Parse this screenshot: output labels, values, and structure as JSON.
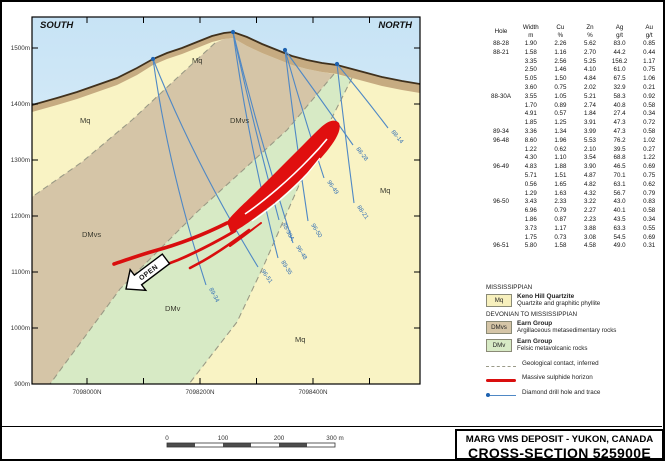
{
  "section": {
    "south_label": "SOUTH",
    "north_label": "NORTH",
    "elevation_labels": [
      "1500m",
      "1400m",
      "1300m",
      "1200m",
      "1100m",
      "1000m",
      "900m"
    ],
    "northing_labels": [
      "7098000N",
      "7098200N",
      "7098400N"
    ],
    "unit_labels": {
      "mq": "Mq",
      "dmvs": "DMvs",
      "dmv": "DMv"
    },
    "open_label": "OPEN",
    "drill_hole_labels": [
      "88-14",
      "88-28",
      "88-21",
      "96-49",
      "96-50",
      "88-30A",
      "96-48",
      "89-35",
      "96-51",
      "89-34"
    ]
  },
  "table": {
    "headers": {
      "hole": "Hole",
      "width": [
        "Width",
        "m"
      ],
      "cu": [
        "Cu",
        "%"
      ],
      "zn": [
        "Zn",
        "%"
      ],
      "ag": [
        "Ag",
        "g/t"
      ],
      "au": [
        "Au",
        "g/t"
      ]
    },
    "rows": [
      [
        "88-28",
        "1.90",
        "2.26",
        "5.62",
        "83.0",
        "0.85"
      ],
      [
        "88-21",
        "1.58",
        "1.16",
        "2.70",
        "44.2",
        "0.44"
      ],
      [
        "",
        "3.35",
        "2.56",
        "5.25",
        "156.2",
        "1.17"
      ],
      [
        "",
        "2.50",
        "1.46",
        "4.10",
        "61.0",
        "0.75"
      ],
      [
        "",
        "5.05",
        "1.50",
        "4.84",
        "67.5",
        "1.06"
      ],
      [
        "",
        "3.60",
        "0.75",
        "2.02",
        "32.9",
        "0.21"
      ],
      [
        "88-30A",
        "3.55",
        "1.05",
        "5.21",
        "58.3",
        "0.92"
      ],
      [
        "",
        "1.70",
        "0.89",
        "2.74",
        "40.8",
        "0.58"
      ],
      [
        "",
        "4.91",
        "0.57",
        "1.84",
        "27.4",
        "0.34"
      ],
      [
        "",
        "1.85",
        "1.25",
        "3.91",
        "47.3",
        "0.72"
      ],
      [
        "89-34",
        "3.36",
        "1.34",
        "3.99",
        "47.3",
        "0.58"
      ],
      [
        "96-48",
        "8.60",
        "1.96",
        "5.53",
        "76.2",
        "1.02"
      ],
      [
        "",
        "1.22",
        "0.62",
        "2.10",
        "39.5",
        "0.27"
      ],
      [
        "",
        "4.30",
        "1.10",
        "3.54",
        "68.8",
        "1.22"
      ],
      [
        "96-49",
        "4.83",
        "1.88",
        "3.90",
        "46.5",
        "0.69"
      ],
      [
        "",
        "5.71",
        "1.51",
        "4.87",
        "70.1",
        "0.75"
      ],
      [
        "",
        "0.56",
        "1.65",
        "4.82",
        "63.1",
        "0.62"
      ],
      [
        "",
        "1.29",
        "1.63",
        "4.32",
        "56.7",
        "0.79"
      ],
      [
        "96-50",
        "3.43",
        "2.33",
        "3.22",
        "43.0",
        "0.83"
      ],
      [
        "",
        "6.96",
        "0.79",
        "2.27",
        "40.1",
        "0.58"
      ],
      [
        "",
        "1.86",
        "0.87",
        "2.23",
        "43.5",
        "0.34"
      ],
      [
        "",
        "3.73",
        "1.17",
        "3.88",
        "63.3",
        "0.55"
      ],
      [
        "",
        "1.75",
        "0.73",
        "3.08",
        "54.5",
        "0.69"
      ],
      [
        "96-51",
        "5.80",
        "1.58",
        "4.58",
        "49.0",
        "0.31"
      ]
    ]
  },
  "legend": {
    "groups": [
      {
        "header": "MISSISSIPPIAN",
        "items": [
          {
            "code": "Mq",
            "name": "Keno Hill Quartzite",
            "desc": "Quartzite and graphitic phyllite"
          }
        ]
      },
      {
        "header": "DEVONIAN TO MISSISSIPPIAN",
        "items": [
          {
            "code": "DMvs",
            "name": "Earn Group",
            "desc": "Argillaceous metasedimentary rocks"
          },
          {
            "code": "DMv",
            "name": "Earn Group",
            "desc": "Felsic metavolcanic rocks"
          }
        ]
      }
    ],
    "symbols": [
      {
        "label": "Geological contact, inferred"
      },
      {
        "label": "Massive sulphide horizon"
      },
      {
        "label": "Diamond drill hole and trace"
      }
    ]
  },
  "scalebar": {
    "labels": [
      "0",
      "100",
      "200",
      "300 m"
    ]
  },
  "title_block": {
    "line1": "MARG VMS DEPOSIT - YUKON, CANADA",
    "line2": "CROSS-SECTION 525900E"
  },
  "colors": {
    "mq": "#f9f3c4",
    "dmvs": "#d5c5a7",
    "dmv": "#d7eac5",
    "colluvium": "#c6ab81",
    "sky_top": "#cae4f5",
    "sulphide_red": "#e00f0f",
    "drill_blue": "#4f88c5"
  }
}
